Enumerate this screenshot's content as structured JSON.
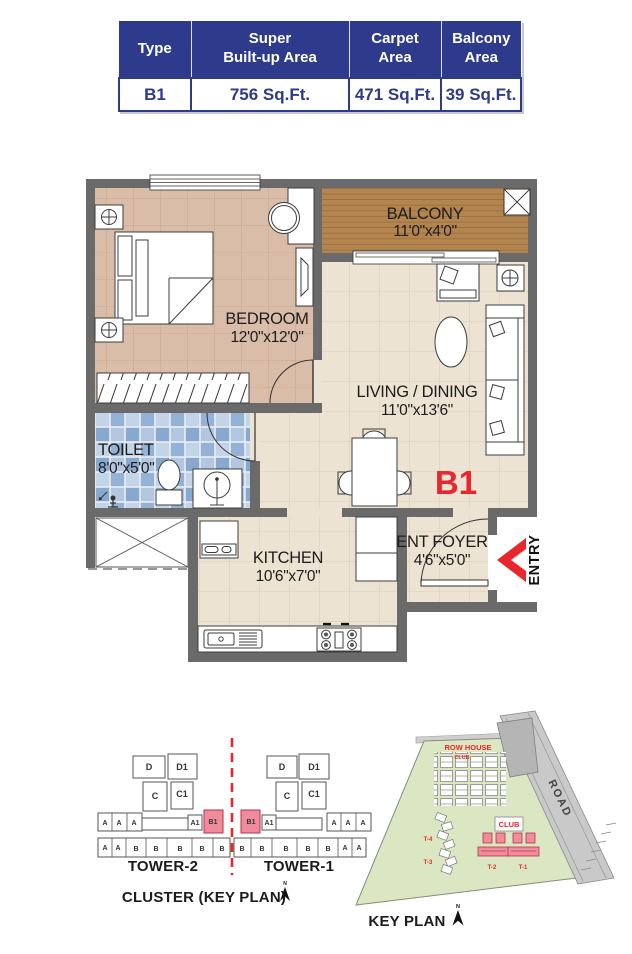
{
  "area_table": {
    "headers": [
      {
        "line1": "Type",
        "line2": ""
      },
      {
        "line1": "Super",
        "line2": "Built-up Area"
      },
      {
        "line1": "Carpet",
        "line2": "Area"
      },
      {
        "line1": "Balcony",
        "line2": "Area"
      }
    ],
    "row": {
      "type": "B1",
      "super_builtup": "756 Sq.Ft.",
      "carpet": "471 Sq.Ft.",
      "balcony": "39 Sq.Ft."
    }
  },
  "floor_plan": {
    "unit_label": "B1",
    "entry_label": "ENTRY",
    "rooms": {
      "balcony": {
        "name": "BALCONY",
        "dims": "11'0\"x4'0\""
      },
      "bedroom": {
        "name": "BEDROOM",
        "dims": "12'0\"x12'0\""
      },
      "living": {
        "name": "LIVING / DINING",
        "dims": "11'0\"x13'6\""
      },
      "toilet": {
        "name": "TOILET",
        "dims": "8'0\"x5'0\""
      },
      "kitchen": {
        "name": "KITCHEN",
        "dims": "10'6\"x7'0\""
      },
      "foyer": {
        "name": "ENT FOYER",
        "dims": "4'6\"x5'0\""
      }
    }
  },
  "cluster_plan": {
    "title": "CLUSTER (KEY PLAN)",
    "north_label": "N",
    "tower_left": "TOWER-2",
    "tower_right": "TOWER-1",
    "labels": {
      "d": "D",
      "d1": "D1",
      "c": "C",
      "c1": "C1",
      "a": "A",
      "a1": "A1",
      "b": "B",
      "b1": "B1"
    }
  },
  "key_plan": {
    "title": "KEY PLAN",
    "north_label": "N",
    "labels": {
      "row_house": "ROW HOUSE",
      "club_upper": "CLUB",
      "club": "CLUB",
      "road": "ROAD",
      "t1": "T-1",
      "t2": "T-2",
      "t3": "T-3",
      "t4": "T-4"
    }
  },
  "colors": {
    "brand_navy": "#2e3a8c",
    "accent_red": "#e8262d",
    "tower_pink": "#ef8b9c",
    "site_green": "#dbe7c3",
    "wall_gray": "#6a6a6a"
  }
}
